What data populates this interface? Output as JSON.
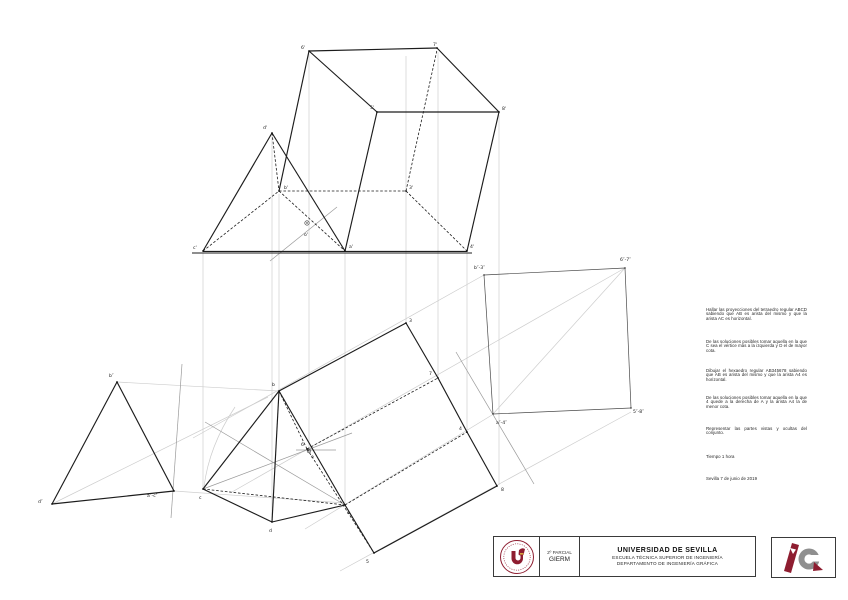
{
  "problem": {
    "paragraphs": [
      "Hallar las proyecciones del tetraedro regular ABCD sabiendo que AB es arista del mismo y que la arista AC es horizontal.",
      "De las soluciones posibles tomar aquella en la que C sea el vértice más a la izquierda y D el de mayor cota.",
      "Dibujar el hexaedro regular AB345678 sabiendo que AB es arista del mismo y que la arista A4 es horizontal.",
      "De las soluciones posibles tomar aquella en la que 4 quede a la derecha de A y la arista A4 la de menor cota.",
      "Representar las partes vistas y ocultas del conjunto.",
      "Tiempo 1 hora",
      "Sevilla 7 de junio de 2019"
    ]
  },
  "titleblock": {
    "exam": "2º PARCIAL",
    "degree": "GIERM",
    "university": "UNIVERSIDAD DE SEVILLA",
    "school": "ESCUELA TÉCNICA SUPERIOR DE INGENIERÍA",
    "department": "DEPARTAMENTO DE INGENIERÍA GRÁFICA",
    "seal_name": "universidad-de-sevilla-seal",
    "ig_logo_name": "ingenieria-grafica-logo"
  },
  "colors": {
    "brand_red": "#8e1d30",
    "logo_gray": "#8f8f8f",
    "line_black": "#1c1c1c",
    "construction_gray": "#cdcdcd"
  },
  "drawing": {
    "labels": [
      {
        "t": "d'",
        "x": 263,
        "y": 129
      },
      {
        "t": "b'",
        "x": 284,
        "y": 189
      },
      {
        "t": "c'",
        "x": 193,
        "y": 249
      },
      {
        "t": "a'",
        "x": 349,
        "y": 248
      },
      {
        "t": "o'",
        "x": 304,
        "y": 236
      },
      {
        "t": "6'",
        "x": 301,
        "y": 49
      },
      {
        "t": "7'",
        "x": 433,
        "y": 46
      },
      {
        "t": "5'",
        "x": 370,
        "y": 109
      },
      {
        "t": "8'",
        "x": 502,
        "y": 110
      },
      {
        "t": "3'",
        "x": 409,
        "y": 189
      },
      {
        "t": "4'",
        "x": 470,
        "y": 248
      },
      {
        "t": "b",
        "x": 272,
        "y": 386
      },
      {
        "t": "c",
        "x": 199,
        "y": 499
      },
      {
        "t": "d",
        "x": 269,
        "y": 532
      },
      {
        "t": "a",
        "x": 347,
        "y": 514
      },
      {
        "t": "6",
        "x": 301,
        "y": 446
      },
      {
        "t": "o",
        "x": 311,
        "y": 458
      },
      {
        "t": "3",
        "x": 409,
        "y": 322
      },
      {
        "t": "7",
        "x": 429,
        "y": 375
      },
      {
        "t": "4",
        "x": 459,
        "y": 430
      },
      {
        "t": "8",
        "x": 501,
        "y": 491
      },
      {
        "t": "5",
        "x": 366,
        "y": 563
      },
      {
        "t": "b″-3″",
        "x": 474,
        "y": 269
      },
      {
        "t": "6″-7″",
        "x": 620,
        "y": 261
      },
      {
        "t": "a″-4″",
        "x": 496,
        "y": 424
      },
      {
        "t": "5″-8″",
        "x": 633,
        "y": 413
      },
      {
        "t": "b″",
        "x": 109,
        "y": 377
      },
      {
        "t": "d″",
        "x": 38,
        "y": 503
      },
      {
        "t": "a″-c″",
        "x": 147,
        "y": 497
      }
    ]
  }
}
